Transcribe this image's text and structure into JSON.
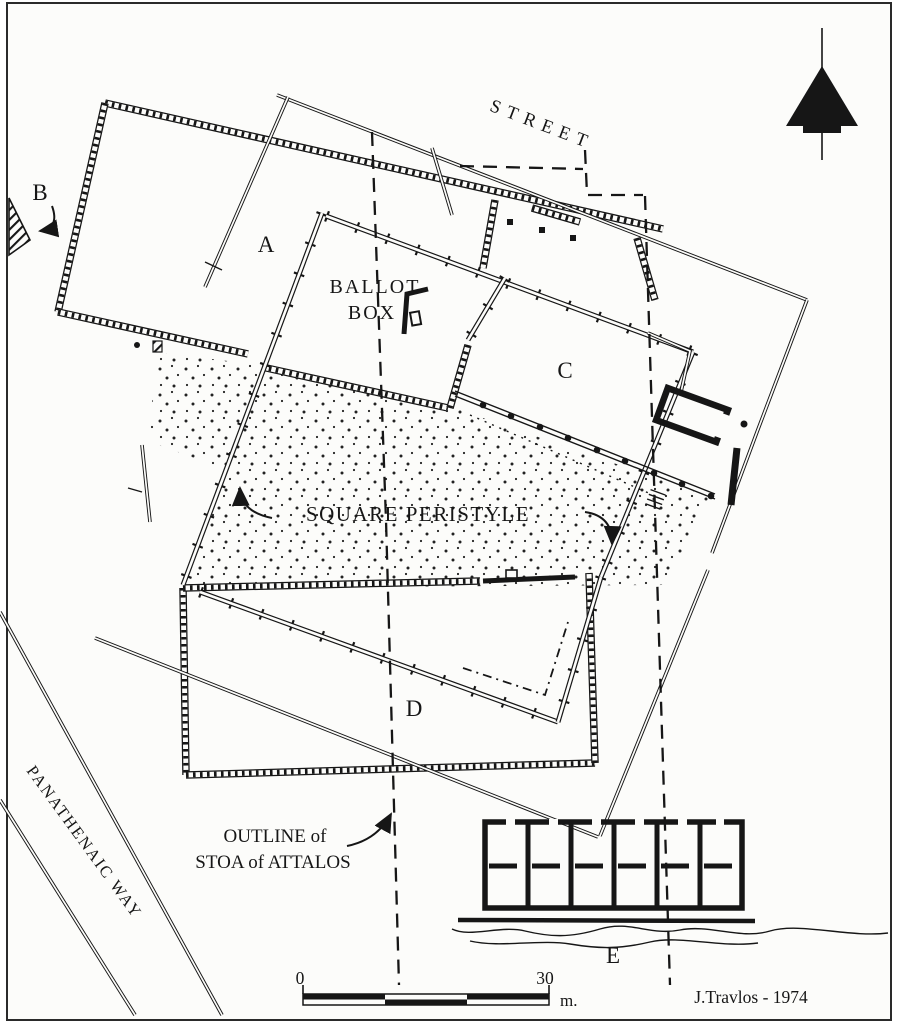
{
  "map": {
    "street_label": "STREET",
    "ballot_box_label_line1": "BALLOT",
    "ballot_box_label_line2": "BOX",
    "square_peristyle_label": "SQUARE PERISTYLE",
    "outline_label_line1": "OUTLINE of",
    "outline_label_line2": "STOA of ATTALOS",
    "panathenaic_way_label": "PANATHENAIC WAY",
    "building_letters": {
      "a": "A",
      "b": "B",
      "c": "C",
      "d": "D",
      "e": "E"
    },
    "scale_bar": {
      "start": "0",
      "end": "30",
      "unit": "m."
    },
    "attribution": "J.Travlos - 1974",
    "colors": {
      "ink": "#161616",
      "paper": "#fcfcfa"
    }
  }
}
